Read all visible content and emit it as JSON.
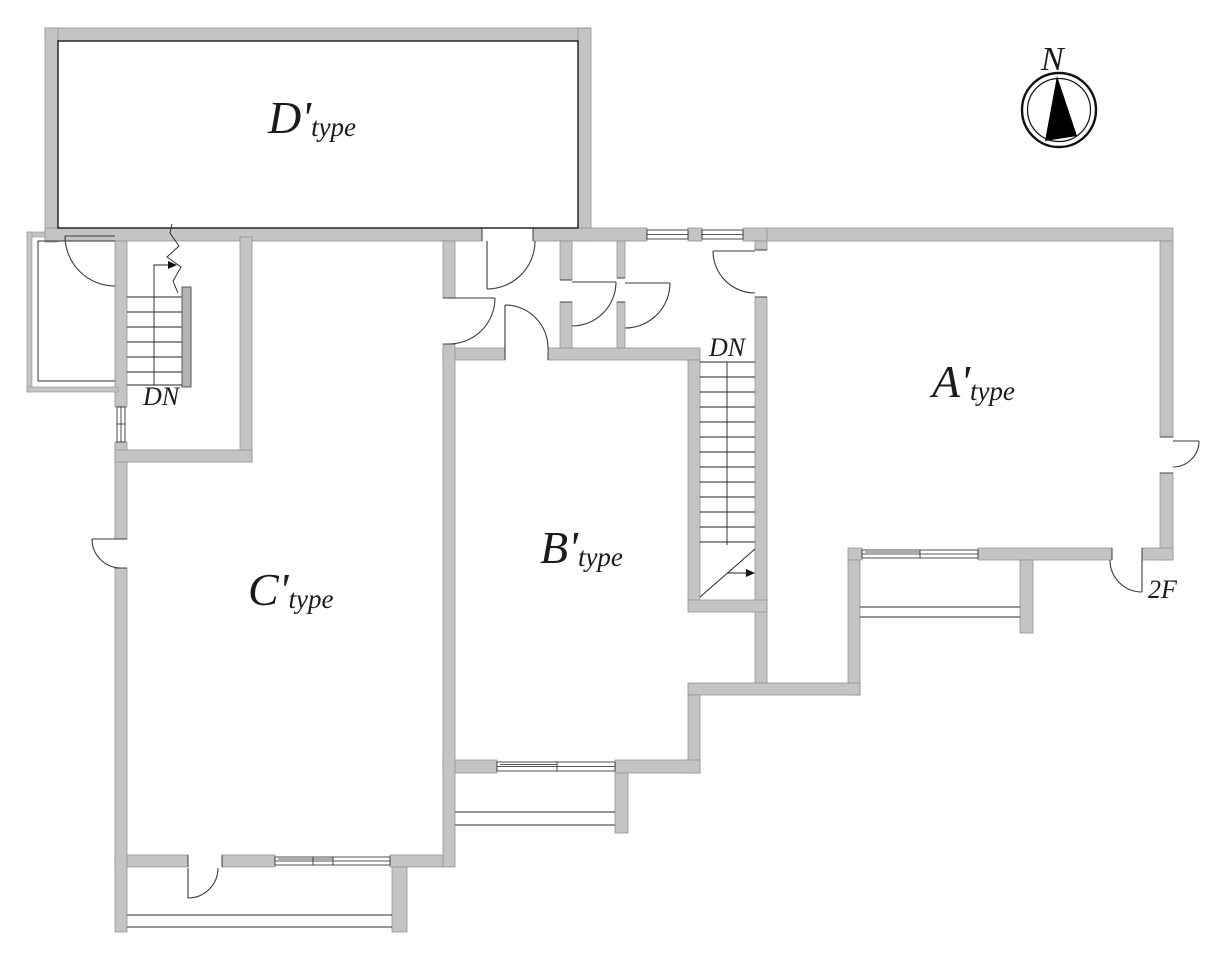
{
  "rooms": [
    {
      "id": "d-type",
      "label_main": "D'",
      "label_sub": "type"
    },
    {
      "id": "c-type",
      "label_main": "C'",
      "label_sub": "type"
    },
    {
      "id": "b-type",
      "label_main": "B'",
      "label_sub": "type"
    },
    {
      "id": "a-type",
      "label_main": "A'",
      "label_sub": "type"
    }
  ],
  "stairs": {
    "left_label": "DN",
    "right_label": "DN"
  },
  "annotations": {
    "floor_door_note": "2F"
  },
  "compass": {
    "label": "N"
  },
  "colors": {
    "wall": "#c4c4c4",
    "wall_edge": "#8f8f8f",
    "line": "#2e2e2e",
    "text": "#1b1b1b",
    "background": "#ffffff",
    "handrail": "#b3b3b3",
    "needle": "#000000"
  }
}
